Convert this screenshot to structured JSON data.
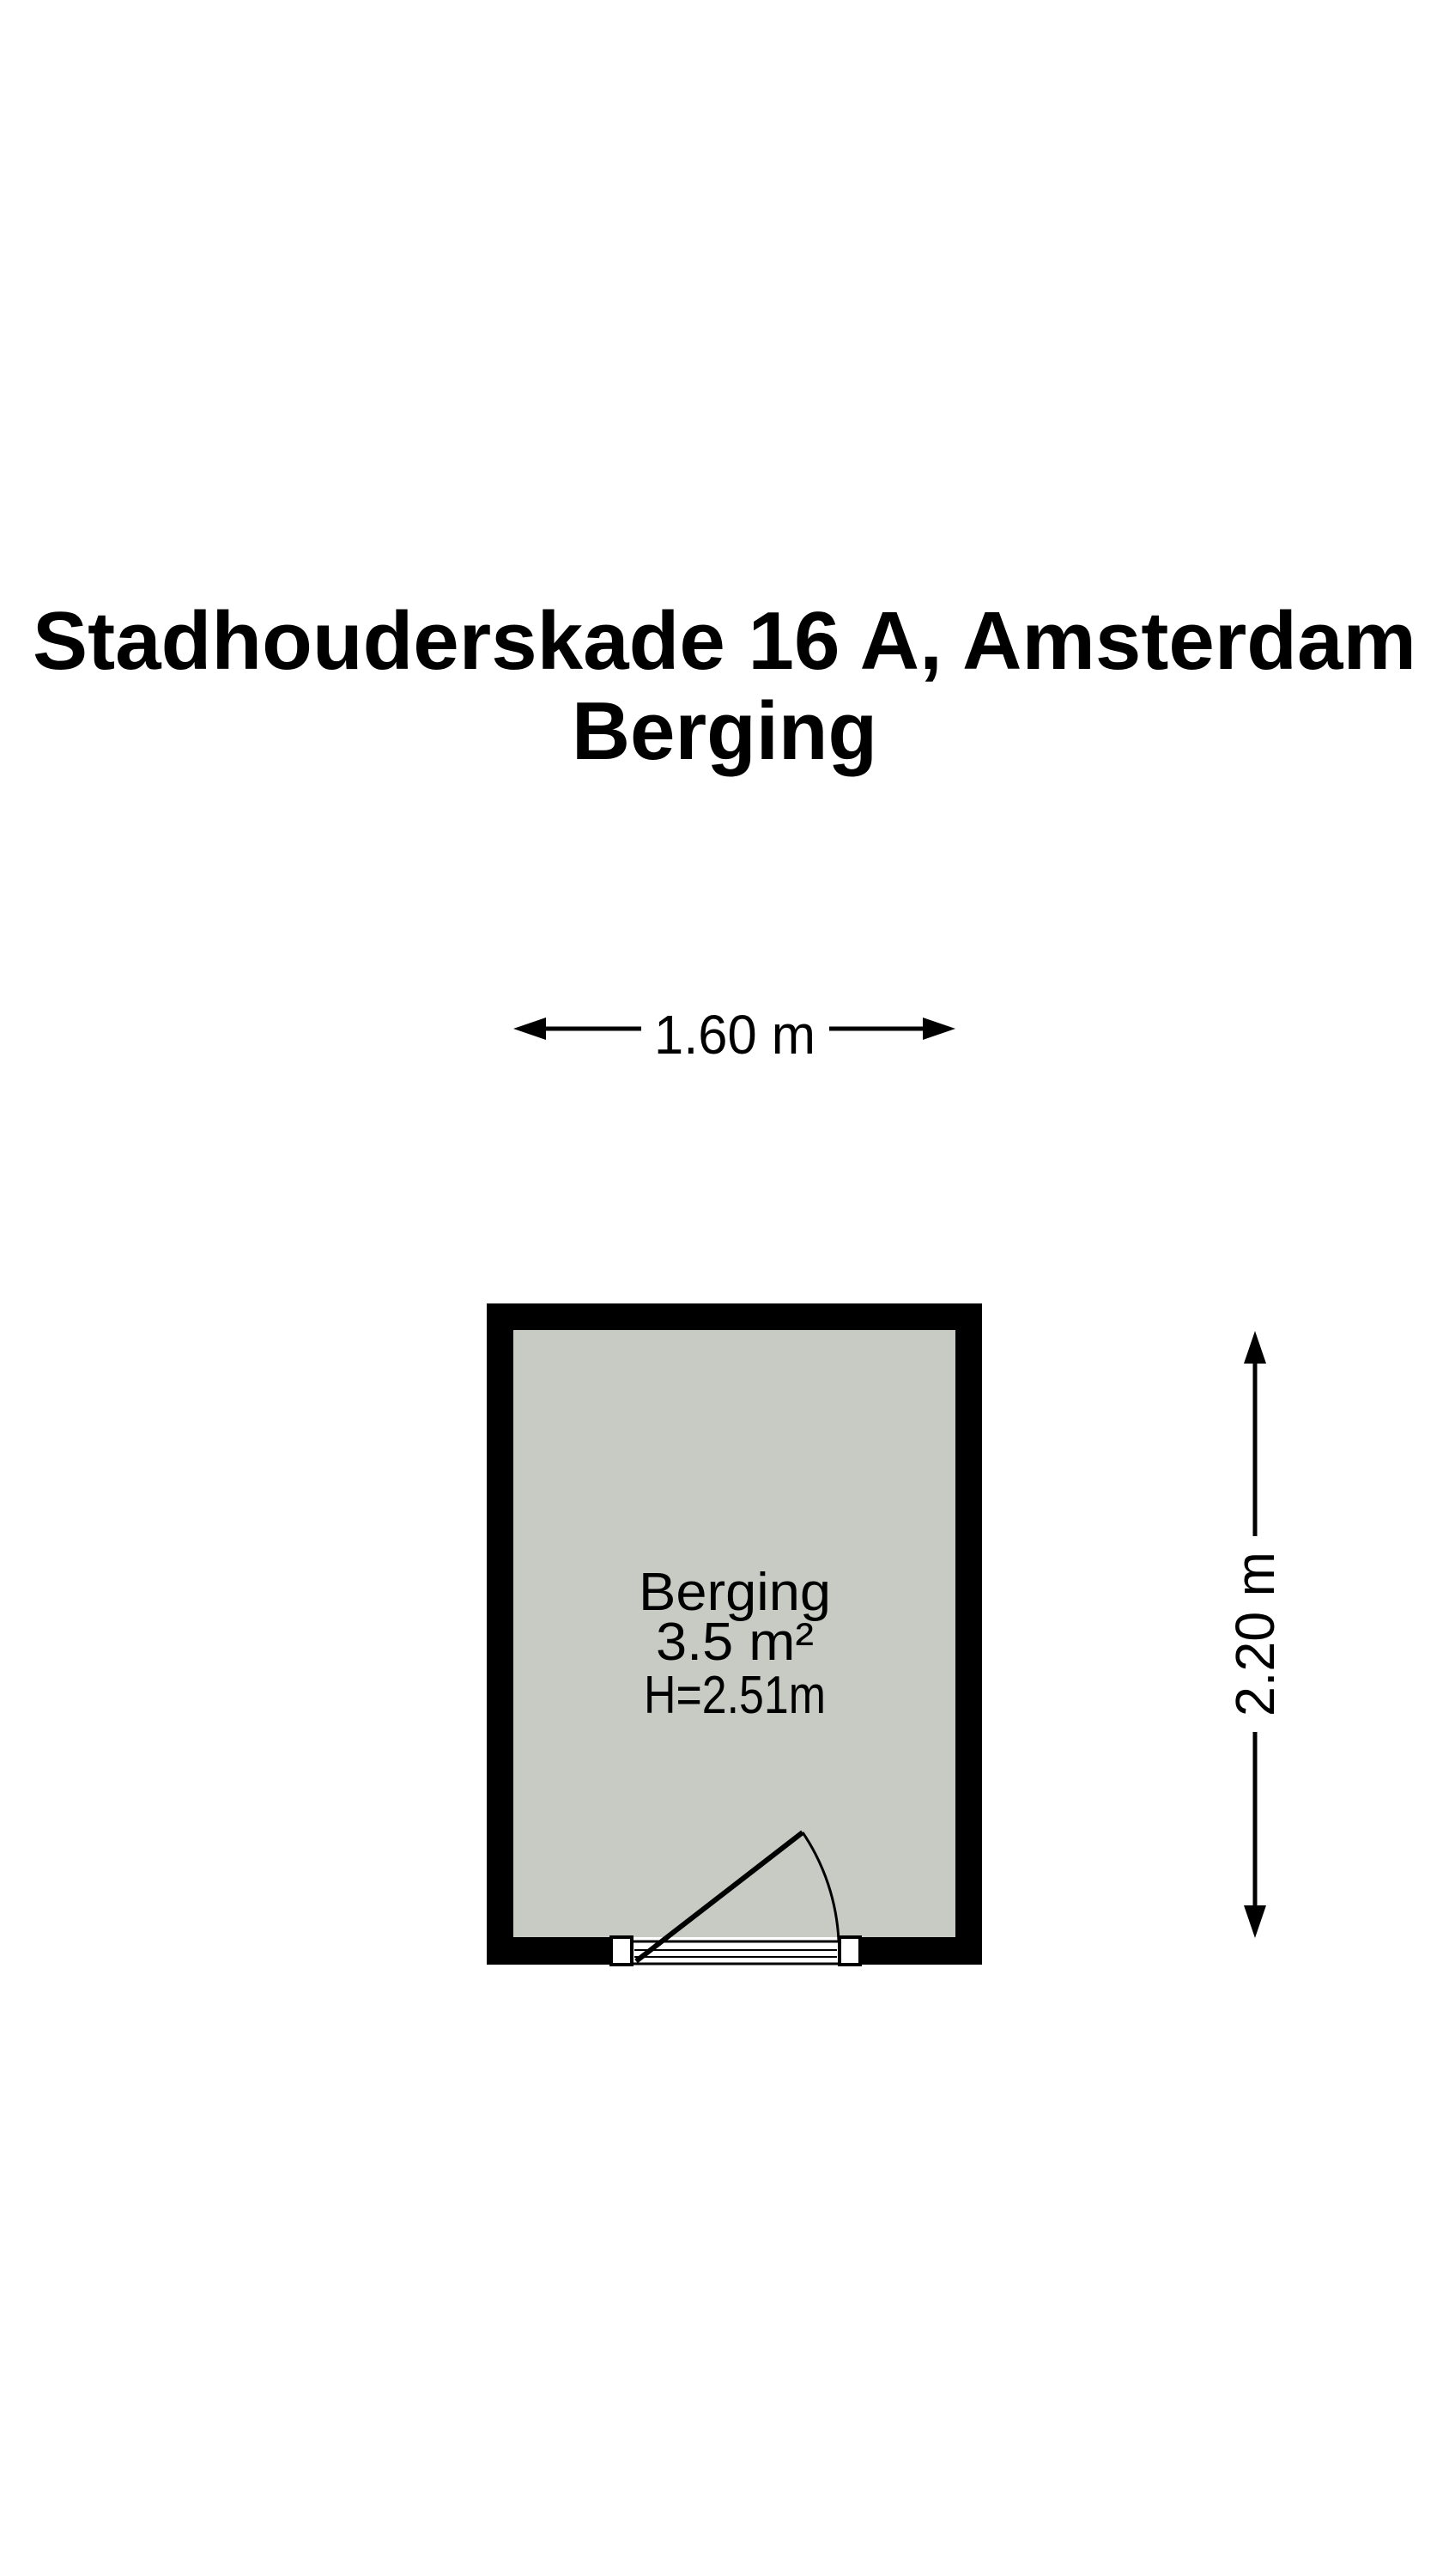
{
  "colors": {
    "background": "#ffffff",
    "wall": "#000000",
    "room_fill": "#c8cbc4",
    "line": "#000000"
  },
  "title": {
    "line1": "Stadhouderskade 16 A, Amsterdam",
    "line2": "Berging"
  },
  "dimensions": {
    "width_label": "1.60 m",
    "height_label": "2.20 m"
  },
  "room": {
    "name": "Berging",
    "area": "3.5 m²",
    "ceiling_height": "H=2.51m"
  }
}
